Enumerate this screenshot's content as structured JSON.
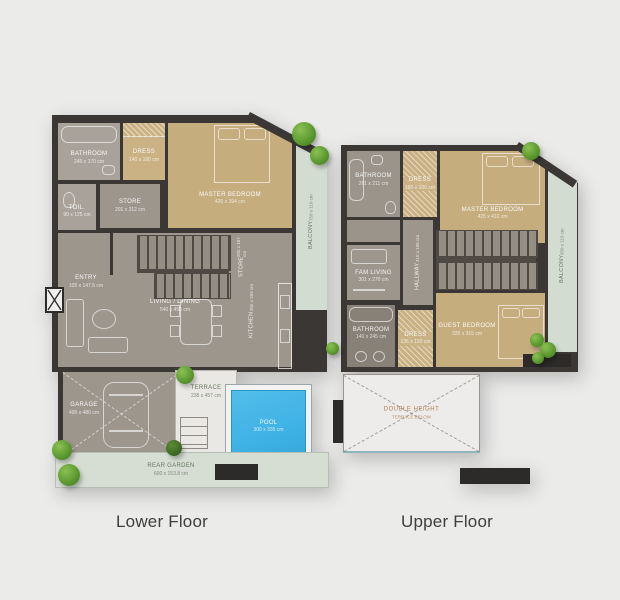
{
  "captions": {
    "lower": "Lower Floor",
    "upper": "Upper Floor"
  },
  "palette": {
    "page_bg": "#ebebea",
    "wall": "#3a3734",
    "floor_gray": "#9c968d",
    "floor_light": "#a8a29a",
    "floor_tan": "#c6ad7e",
    "balcony_green": "#d3dcd1",
    "pool_blue": "#3fb2e5",
    "terrace": "#eae8e4",
    "tree_green": "#5d9b31",
    "void_label_orange": "#b08058",
    "caption_text": "#3e3e3e"
  },
  "icons": [
    "tree-icon",
    "plant-icon",
    "bed-icon",
    "bathtub-icon",
    "sink-icon",
    "toilet-icon",
    "sofa-icon",
    "dining-table-icon",
    "car-icon",
    "kitchen-counter-icon",
    "stairs",
    "door-arc",
    "utility-box"
  ],
  "lower_floor": {
    "rooms": {
      "bathroom": {
        "name": "BATHROOM",
        "dims": "245 x 170 cm"
      },
      "dress": {
        "name": "DRESS",
        "dims": "140 x 160 cm"
      },
      "toilet": {
        "name": "TOIL.",
        "dims": "90 x 125 cm"
      },
      "store": {
        "name": "STORE",
        "dims": "201 x 212 cm"
      },
      "master_bedroom": {
        "name": "MASTER BEDROOM",
        "dims": "420 x 394 cm"
      },
      "entry": {
        "name": "ENTRY",
        "dims": "105 x 147.5 cm"
      },
      "living_dining": {
        "name": "LIVING / DINING",
        "dims": "540 x 455 cm"
      },
      "stair_store": {
        "name": "STORE",
        "dims": "205 x 187 cm"
      },
      "kitchen": {
        "name": "KITCHEN",
        "dims": "305 x 258 cm"
      },
      "garage": {
        "name": "GARAGE",
        "dims": "495 x 480 cm"
      },
      "terrace": {
        "name": "TERRACE",
        "dims": "238 x 457 cm"
      },
      "pool": {
        "name": "POOL",
        "dims": "300 x 335 cm"
      },
      "balcony": {
        "name": "BALCONY",
        "dims": "750 x 110 cm"
      },
      "garden": {
        "name": "REAR GARDEN",
        "dims": "600 x 153.8 cm"
      }
    }
  },
  "upper_floor": {
    "rooms": {
      "bathroom_top": {
        "name": "BATHROOM",
        "dims": "261 x 211 cm"
      },
      "dress_top": {
        "name": "DRESS",
        "dims": "180 x 200 cm"
      },
      "master_bedroom": {
        "name": "MASTER BEDROOM",
        "dims": "425 x 410 cm"
      },
      "fam_living": {
        "name": "FAM LIVING",
        "dims": "301 x 270 cm"
      },
      "hallway": {
        "name": "HALLWAY",
        "dims": "410 x 108 cm"
      },
      "bathroom_lower": {
        "name": "BATHROOM",
        "dims": "140 x 245 cm"
      },
      "dress_lower": {
        "name": "DRESS",
        "dims": "135 x 120 cm"
      },
      "guest_bedroom": {
        "name": "GUEST BEDROOM",
        "dims": "320 x 315 cm"
      },
      "balcony": {
        "name": "BALCONY",
        "dims": "950 x 110 cm"
      },
      "void": {
        "name": "DOUBLE HEIGHT",
        "dims": "TERRACE BELOW"
      }
    }
  }
}
